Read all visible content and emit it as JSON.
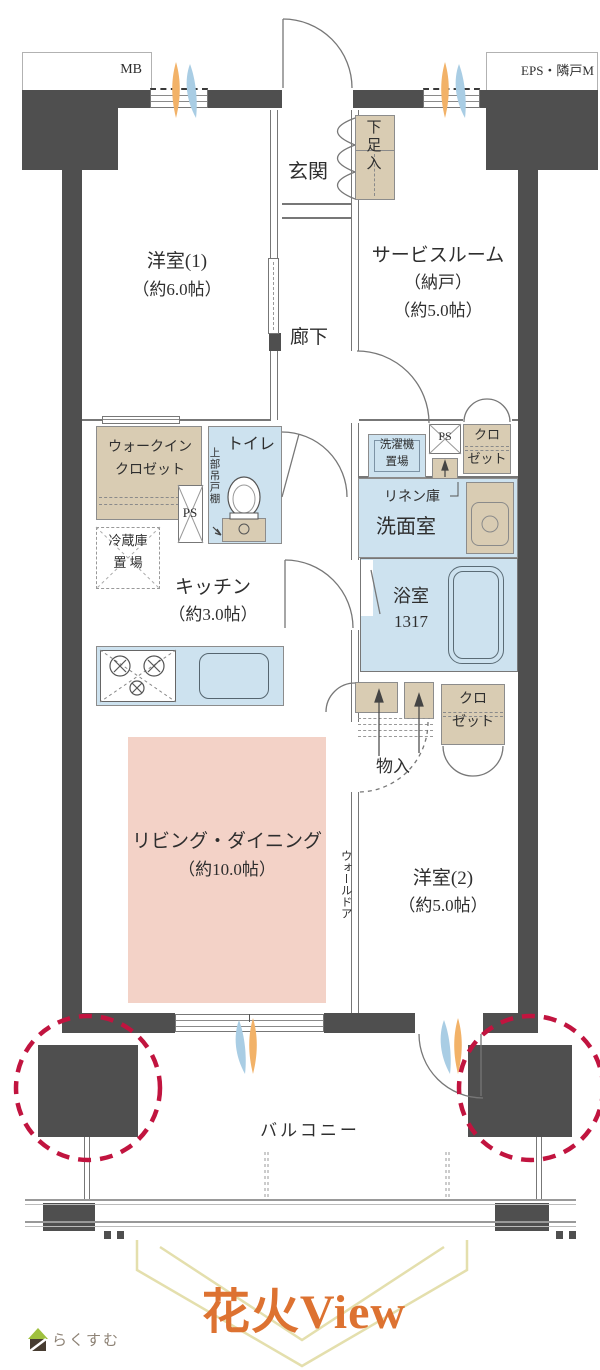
{
  "header": {
    "mb": "MB",
    "eps": "EPS・隣戸M"
  },
  "rooms": {
    "genkan": "玄関",
    "shoe_box": "下足入",
    "west1_name": "洋室(1)",
    "west1_size": "（約6.0帖）",
    "service_name": "サービスルーム",
    "service_sub": "（納戸）",
    "service_size": "（約5.0帖）",
    "corridor": "廊下",
    "wic_line1": "ウォークイン",
    "wic_line2": "クロゼット",
    "ps": "PS",
    "toilet": "トイレ",
    "upper_cabinet": "上部吊戸棚",
    "laundry_line1": "洗濯機",
    "laundry_line2": "置場",
    "closet_line1": "クロ",
    "closet_line2": "ゼット",
    "linen": "リネン庫",
    "washroom": "洗面室",
    "fridge_line1": "冷蔵庫",
    "fridge_line2": "置 場",
    "kitchen_name": "キッチン",
    "kitchen_size": "（約3.0帖）",
    "bath_name": "浴室",
    "bath_size": "1317",
    "storage": "物入",
    "ld_name": "リビング・ダイニング",
    "ld_size": "（約10.0帖）",
    "wall_door": "ウォールドア",
    "west2_name": "洋室(2)",
    "west2_size": "（約5.0帖）",
    "balcony": "バルコニー"
  },
  "footer": {
    "view_label": "花火View",
    "brand": "らくすむ"
  },
  "colors": {
    "wall": "#4f4f4f",
    "closet_beige": "#d9ccb3",
    "water_blue": "#cde2ef",
    "living_pink": "#f3d2c7",
    "circle_red": "#c1143f",
    "view_orange": "#dd7231",
    "chevron": "#e4dfad",
    "flame_orange": "#f2b268",
    "flame_blue": "#a9cde4"
  }
}
